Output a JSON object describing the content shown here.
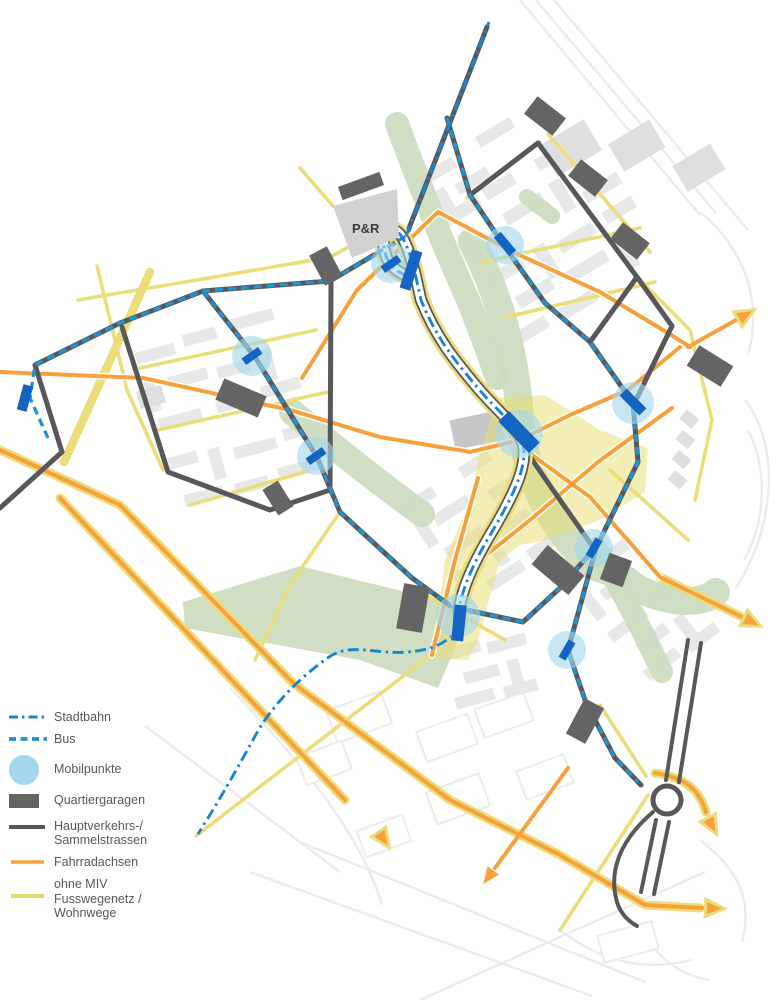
{
  "map": {
    "pr_label": "P&R"
  },
  "legend": {
    "items": [
      {
        "id": "stadtbahn",
        "label": "Stadtbahn",
        "swatch": "dashdot-line"
      },
      {
        "id": "bus",
        "label": "Bus",
        "swatch": "dashed-line"
      },
      {
        "id": "mobilpunkte",
        "label": "Mobilpunkte",
        "swatch": "circle"
      },
      {
        "id": "quartiergaragen",
        "label": "Quartiergaragen",
        "swatch": "rect"
      },
      {
        "id": "hauptstrassen",
        "label": "Hauptverkehrs-/",
        "label2": "Sammelstrassen",
        "swatch": "solid-line"
      },
      {
        "id": "fahrradachsen",
        "label": "Fahrradachsen",
        "swatch": "solid-line"
      },
      {
        "id": "fusswege",
        "label": "ohne MIV",
        "label2": "Fusswegenetz /",
        "label3": "Wohnwege",
        "swatch": "solid-line"
      }
    ]
  },
  "colors": {
    "stadtbahn": "#1886cf",
    "bus": "#2093d2",
    "mobilpunkt": "#a5d7ec",
    "station": "#1464c4",
    "garage": "#646464",
    "street": "#58585a",
    "bike": "#f6a13c",
    "path": "#eadd7a",
    "green": "#ccdcbe",
    "zone": "#e8de6d",
    "building": "#e8e8e8",
    "context": "#ececec",
    "text": "#58585a"
  }
}
